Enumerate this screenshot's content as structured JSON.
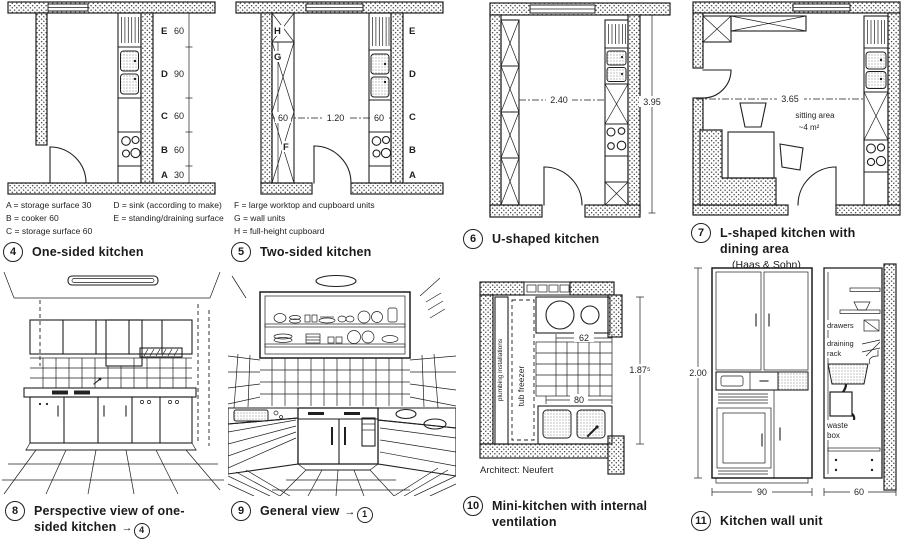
{
  "p4": {
    "number": "4",
    "caption": "One-sided kitchen",
    "rows": [
      {
        "l": "E",
        "v": "60"
      },
      {
        "l": "D",
        "v": "90"
      },
      {
        "l": "C",
        "v": "60"
      },
      {
        "l": "B",
        "v": "60"
      },
      {
        "l": "A",
        "v": "30"
      }
    ],
    "legend_left": [
      "A = storage surface 30",
      "B = cooker 60",
      "C = storage surface 60"
    ],
    "legend_right": [
      "D = sink (according to make)",
      "E = standing/draining surface"
    ]
  },
  "p5": {
    "number": "5",
    "caption": "Two-sided kitchen",
    "letters": {
      "h": "H",
      "g": "G",
      "f": "F"
    },
    "dims": {
      "left": "60",
      "mid": "1.20",
      "right": "60"
    },
    "wall_letters": [
      "E",
      "D",
      "C",
      "B",
      "A"
    ],
    "legend": [
      "F = large worktop and cupboard units",
      "G = wall units",
      "H = full-height cupboard"
    ]
  },
  "p6": {
    "number": "6",
    "caption": "U-shaped kitchen",
    "dims": {
      "width": "2.40",
      "depth": "3.95"
    }
  },
  "p7": {
    "number": "7",
    "caption": "L-shaped kitchen with dining area",
    "subcaption": "(Haas & Sohn)",
    "dims": {
      "width": "3.65"
    },
    "labels": {
      "sitting_area": "sitting area",
      "area_value": "~4 m²"
    }
  },
  "p8": {
    "number": "8",
    "caption": "Perspective view of one-sided kitchen",
    "ref_arrow": "→",
    "ref_number": "4"
  },
  "p9": {
    "number": "9",
    "caption": "General view",
    "ref_arrow": "→",
    "ref_number": "1"
  },
  "p10": {
    "number": "10",
    "caption": "Mini-kitchen with internal ventilation",
    "credit": "Architect: Neufert",
    "labels": {
      "plumbing": "plumbing installations",
      "freezer": "tub freezer"
    },
    "dims": {
      "top": "62",
      "bottom": "80",
      "height": "1.87⁵"
    }
  },
  "p11": {
    "number": "11",
    "caption": "Kitchen wall unit",
    "labels": {
      "drawers": "drawers",
      "draining_1": "draining",
      "draining_2": "rack",
      "waste_1": "waste",
      "waste_2": "box"
    },
    "dims": {
      "height": "2.00",
      "front_width": "90",
      "side_width": "60"
    }
  }
}
